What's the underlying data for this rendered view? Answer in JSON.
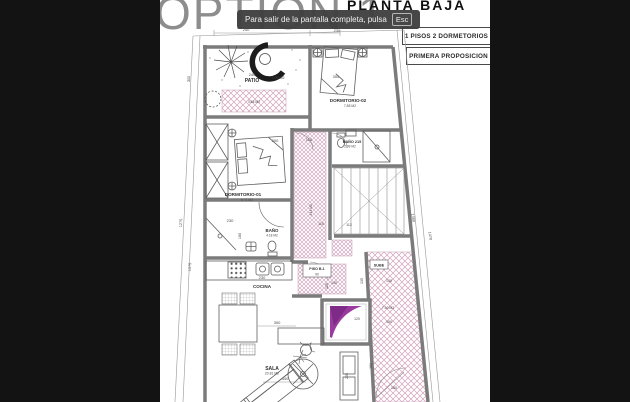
{
  "header": {
    "option_title": "OPTION 1",
    "plan_title": "PLANTA BAJA",
    "fullscreen_toast": {
      "message": "Para salir de la pantalla completa, pulsa",
      "key_label": "Esc"
    },
    "badges": [
      {
        "label": "1 PISOS 2 DORMETORIOS"
      },
      {
        "label": "PRIMERA PROPOSICION"
      }
    ]
  },
  "plan": {
    "rooms": {
      "patio": {
        "name": "PATIO",
        "width_dim": "240",
        "area": "7.09 M2",
        "planter_area": "3.64 M2"
      },
      "dormitorio_02": {
        "name": "DORMITORIO-02",
        "area": "7.85 M2",
        "bed_dim": "305"
      },
      "bano_2": {
        "name": "BAÑO 215",
        "area": "2.09 M2"
      },
      "dormitorio_01": {
        "name": "DORMITORIO-01",
        "area": "6.71 M2",
        "bed_dim": "200"
      },
      "pasillo": {
        "area": "4.14 M2",
        "width_dim": "110"
      },
      "bano_1": {
        "name": "BAÑO",
        "area": "4.18 M2",
        "width_dim": "230",
        "depth_dim": "160"
      },
      "cocina": {
        "name": "COCINA",
        "width_dim": "230"
      },
      "piso_b1": {
        "name": "PISO B-1",
        "dim": "90"
      },
      "escalera": {
        "sube_label": "SUBE",
        "dims": {
          "d115": "115",
          "d112": "112",
          "d140": "140",
          "d125": "125",
          "d135": "135",
          "d130": "130"
        }
      },
      "recibidor": {
        "area": "7.30 M2",
        "dims": {
          "d150": "150",
          "d160": "160",
          "d180": "180"
        }
      },
      "ascensor": {
        "dim": "120"
      },
      "sala": {
        "name": "SALA",
        "area": "20.81 M2",
        "dims": {
          "d350": "350",
          "d440": "440",
          "d205": "205"
        }
      }
    },
    "site_dims": {
      "top_left": "240",
      "top_right": "230",
      "left_1": "300",
      "left_2": "1275",
      "left_3": "1075",
      "right_1": "1380",
      "right_2": "1470"
    }
  },
  "colors": {
    "letterbox": "#131313",
    "wall_gray": "#7b7b7b",
    "hatch_pink": "#d3a0bb",
    "watermark_purple": "#9b3a9e",
    "toast_bg": "#3f3f3f",
    "title_gray": "#8d8d8d"
  }
}
